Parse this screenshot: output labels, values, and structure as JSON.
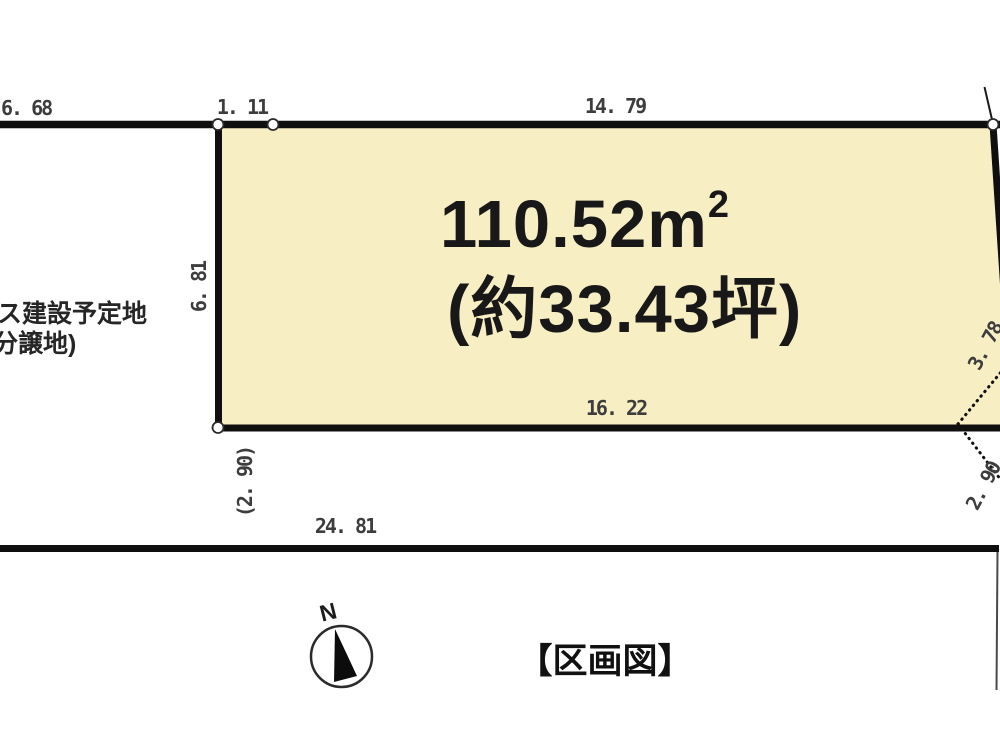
{
  "title": "【区画図】",
  "parcel": {
    "area_value": "110.52",
    "area_unit_base": "m",
    "area_unit_exponent": "2",
    "area_tsubo": "(約33.43坪)"
  },
  "dimensions": {
    "top_left_road": "6. 68",
    "top_offset": "1. 11",
    "top_edge": "14. 79",
    "left_edge": "6. 81",
    "bottom_edge": "16. 22",
    "left_lower": "(2. 90)",
    "road_frontage": "24. 81",
    "right_upper": "3. 78",
    "right_lower": "2. 90"
  },
  "side_note": {
    "line1": "ス建設予定地",
    "line2": "分譲地)"
  },
  "compass": {
    "label": "N"
  },
  "colors": {
    "parcel_fill": "#f8eec4",
    "boundary": "#0f0f0f",
    "dimension_text": "#3d3d3d"
  }
}
